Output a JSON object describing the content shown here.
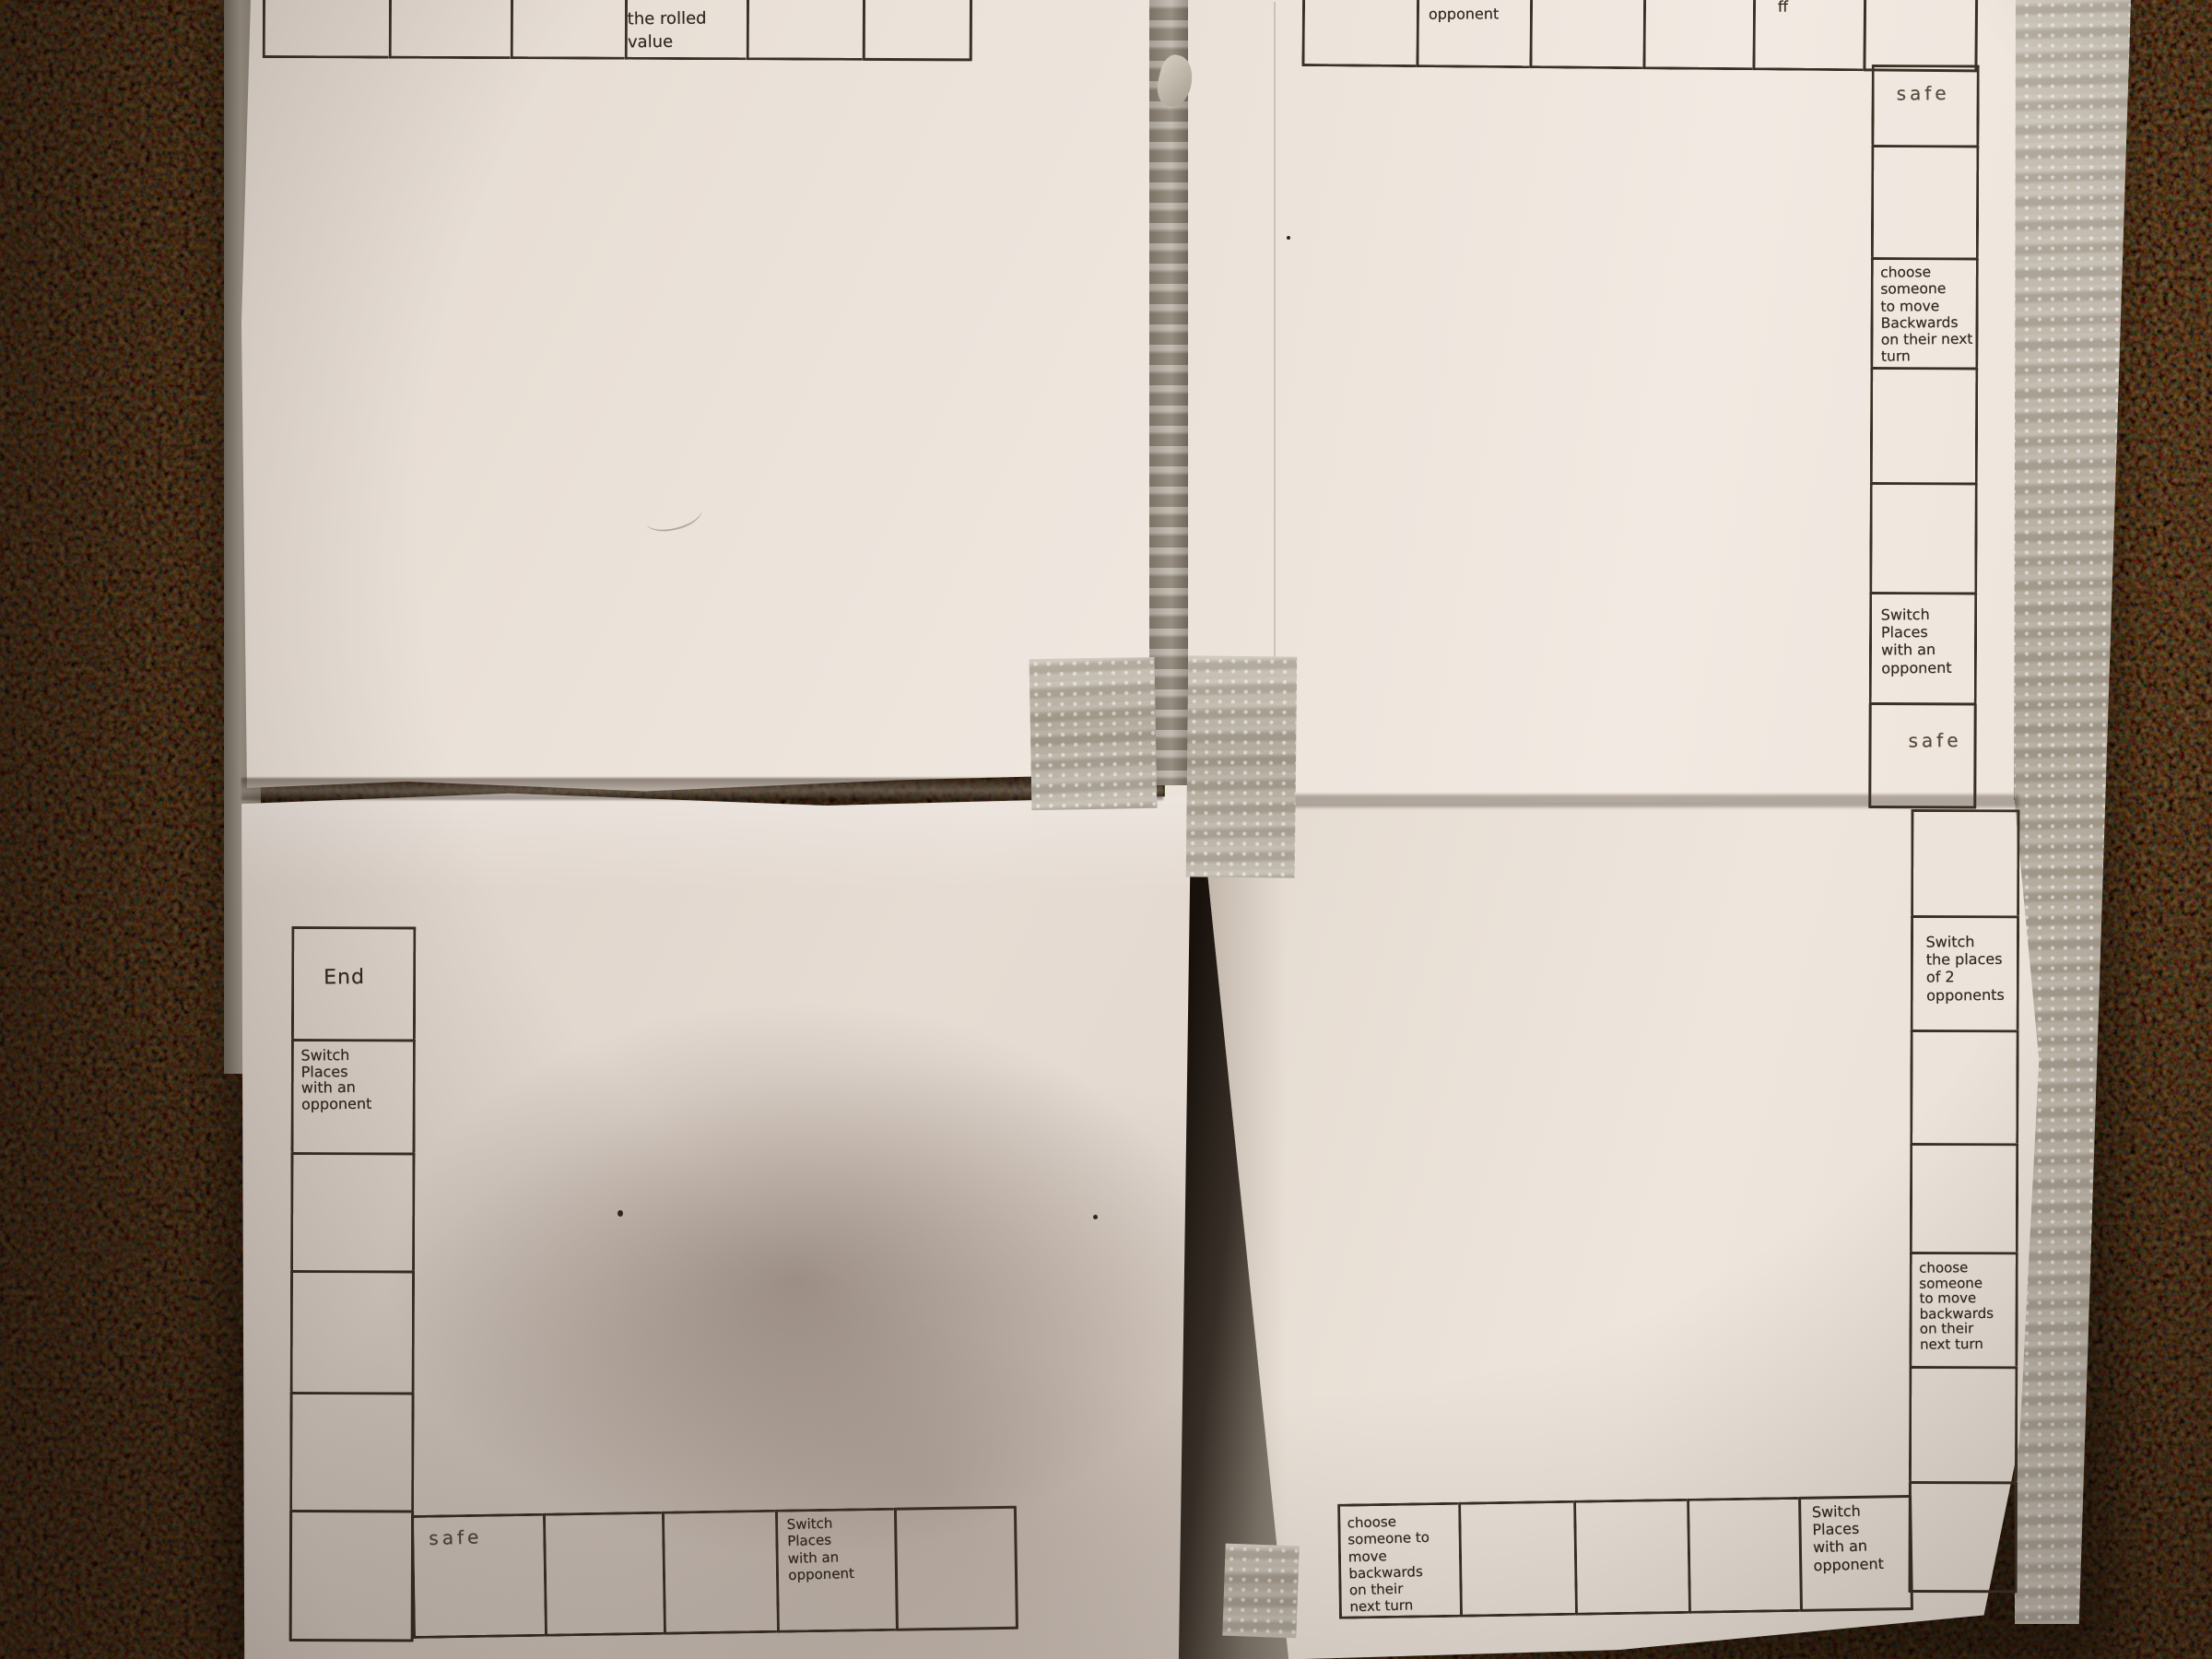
{
  "scene_label": "Homemade paper board game: four taped-together sheets with hand-drawn squares, photographed on a multicolor carpet",
  "colors": {
    "carpet_base": "#241712",
    "paper": "#ece3da",
    "ink": "#3b3025",
    "tape_silver": "#c6beb1",
    "cardboard": "#8d8578"
  },
  "papers": {
    "top_left": {
      "top_row_cells": [
        "",
        "",
        "",
        "the rolled\nvalue",
        "",
        ""
      ]
    },
    "top_right": {
      "top_row_cells": [
        "",
        "opponent",
        "",
        "",
        "ff",
        ""
      ],
      "right_column_cells": [
        "safe",
        "",
        "choose\nsomeone\nto move\nBackwards\non their next\nturn",
        "",
        "",
        "Switch\nPlaces\nwith an\nopponent",
        "safe"
      ]
    },
    "bottom_right": {
      "right_column_cells": [
        "",
        "Switch\nthe places\nof 2\nopponents",
        "",
        "",
        "choose someone\nto move\nbackwards\non their\nnext turn",
        "",
        ""
      ],
      "bottom_row_cells": [
        "choose\nsomeone to\nmove backwards\non their\nnext turn",
        "",
        "",
        "",
        "Switch\nPlaces\nwith an\nopponent"
      ]
    },
    "bottom_left": {
      "left_column_cells": [
        "End",
        "Switch\nPlaces\nwith an\nopponent",
        "",
        "",
        "",
        ""
      ],
      "bottom_row_cells": [
        "safe",
        "",
        "",
        "Switch\nPlaces\nwith an\nopponent",
        ""
      ]
    }
  }
}
